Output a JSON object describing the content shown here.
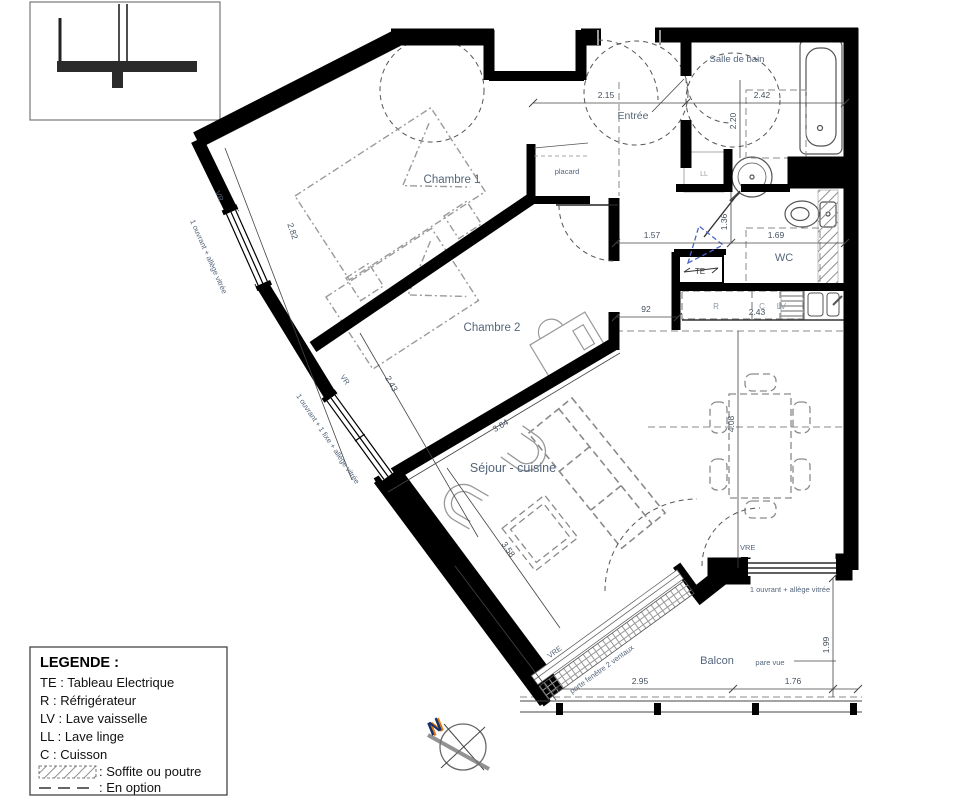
{
  "legend": {
    "heading": "LEGENDE :",
    "items": [
      "TE : Tableau Electrique",
      "R : Réfrigérateur",
      "LV : Lave vaisselle",
      "LL : Lave linge",
      "C : Cuisson"
    ],
    "soffite": ": Soffite ou poutre",
    "option": ": En option"
  },
  "rooms": {
    "chambre1": "Chambre 1",
    "chambre2": "Chambre 2",
    "sejour": "Séjour - cuisine",
    "entree": "Entrée",
    "salle_de_bain": "Salle de bain",
    "wc": "WC",
    "placard": "placard",
    "balcon": "Balcon"
  },
  "appliances": {
    "te": "TE",
    "r": "R",
    "c": "C",
    "lv": "LV",
    "ll": "LL"
  },
  "windows": {
    "vr1": "VR",
    "vr2": "VR",
    "vre1": "VRE",
    "vre2": "VRE",
    "note1": "1 ouvrant + allège vitrée",
    "note2": "1 ouvrant + 1 fixe + allège vitrée",
    "note3": "1 ouvrant + allège vitrée",
    "porte_fenetre": "porte fenêtre 2 ventaux",
    "pare_vue": "pare vue"
  },
  "dimensions": {
    "entree_w": "2.15",
    "sdb_w": "2.42",
    "sdb_h": "2.20",
    "wc_a": "1.57",
    "wc_b": "1.36",
    "wc_c": "1.69",
    "kitchen_off": "92",
    "kitchen_w": "2.43",
    "ch1": "2.82",
    "ch2": "2.43",
    "sejour_a": "3.64",
    "sejour_b": "3.58",
    "sejour_c": "4.08",
    "balcon_a": "2.95",
    "balcon_b": "1.76",
    "balcon_c": "1.99"
  },
  "compass": {
    "north": "N"
  },
  "colors": {
    "wall": "#000000",
    "label": "#54657a",
    "dimension": "#44505e",
    "option_blue": "#4a63c8",
    "north_orange": "#e07b10",
    "north_navy": "#17306b"
  }
}
